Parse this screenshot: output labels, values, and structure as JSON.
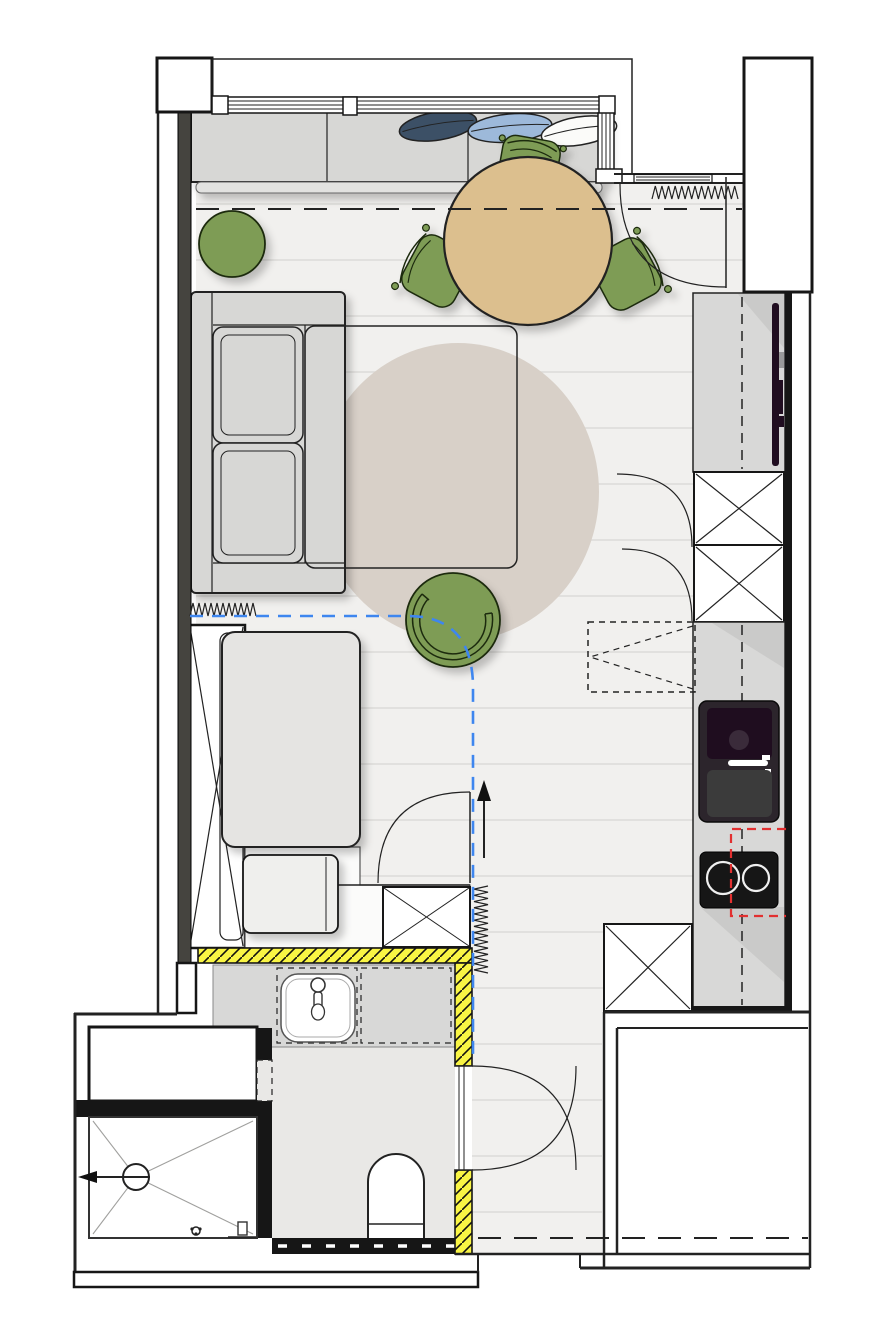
{
  "meta": {
    "width": 870,
    "height": 1332,
    "kind": "studio-apartment-floor-plan",
    "visible_text": "none"
  },
  "colors": {
    "outline": "#222222",
    "wall_dark": "#161616",
    "wall_band": "#45443f",
    "floor_base": "#f1f0ee",
    "plank_line": "#dcdbd8",
    "bath_floor": "#e9e8e6",
    "rug": "#d8d0c8",
    "furniture_gray": "#d7d7d5",
    "furniture_light": "#e5e4e2",
    "bench_lip": "#e2e2e0",
    "green": "#7e9c55",
    "green_border": "#1e2c10",
    "table_tan": "#dcbf8e",
    "pillow_navy": "#3c5066",
    "pillow_blue": "#9db9da",
    "pillow_white": "#fbfbf9",
    "yellow": "#f9f544",
    "counter": "#d8d8d7",
    "counter_shade": "#c5c5c4",
    "appliance_black": "#161616",
    "sink_dark": "#1f0d1f",
    "sink_mid": "#2c252c",
    "sink_gray": "#3b3b3b",
    "tv_black": "#200d20",
    "blue_route": "#3e86ef",
    "red_route": "#e23030",
    "slope_line": "#a0a09e",
    "burner_ring": "#efefef"
  },
  "legend": {
    "rooms": [
      "living-sleeping-area",
      "kitchen-run",
      "entry-hall",
      "bathroom",
      "shower",
      "balcony",
      "neighbor-space"
    ],
    "furniture": [
      "window-bench",
      "pillows",
      "dining-table",
      "dining-chairs",
      "sofa",
      "sofa-bed-outline",
      "round-rug",
      "pouf",
      "tub-chair",
      "wardrobe",
      "bed",
      "foot-bench",
      "kitchen-counters",
      "tall-cabinets",
      "kitchen-sink",
      "cooktop",
      "wall-tv",
      "bath-vanity",
      "wash-basin",
      "toilet",
      "shower-drain"
    ],
    "symbols": [
      "radiator-zigzag",
      "door-swing-arc",
      "new-wall-yellow-hatch",
      "blue-dashed-route",
      "red-dashed-route",
      "section-dashed-line",
      "entry-arrow"
    ]
  }
}
